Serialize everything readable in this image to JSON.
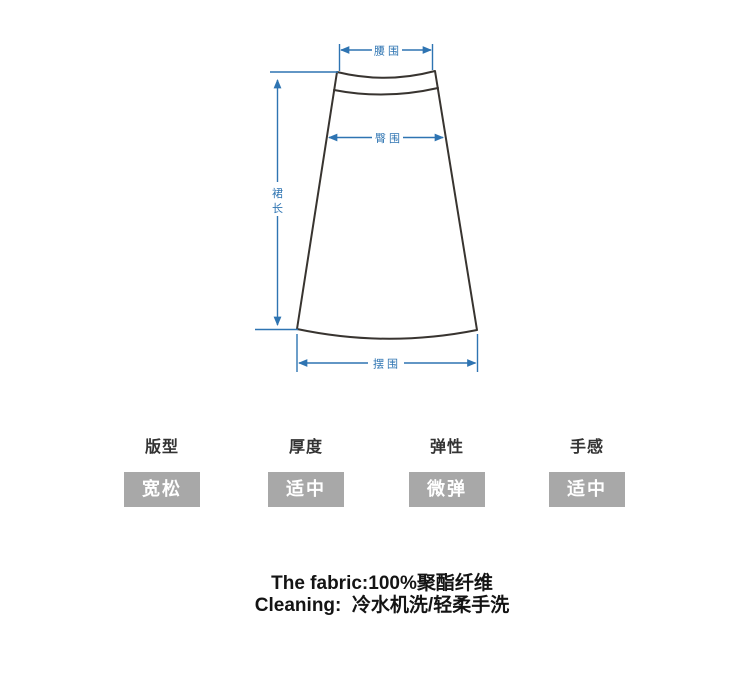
{
  "diagram": {
    "waist_label": "腰围",
    "hip_label": "臀围",
    "skirt_length_char_1": "裙",
    "skirt_length_char_2": "长",
    "sweep_label": "摆围",
    "dimension_line_color": "#2e74b2",
    "skirt_outline_color": "#383430"
  },
  "attributes": [
    {
      "label": "版型",
      "value": "宽松"
    },
    {
      "label": "厚度",
      "value": "适中"
    },
    {
      "label": "弹性",
      "value": "微弹"
    },
    {
      "label": "手感",
      "value": "适中"
    }
  ],
  "fabric_info": {
    "fabric_line": "The fabric:100%聚酯纤维",
    "cleaning_line": "Cleaning:  冷水机洗/轻柔手洗"
  },
  "colors": {
    "value_box_bg": "#a8a8a8",
    "value_box_text": "#ffffff",
    "attr_label_text": "#333333",
    "fabric_text": "#141414",
    "background": "#ffffff"
  }
}
